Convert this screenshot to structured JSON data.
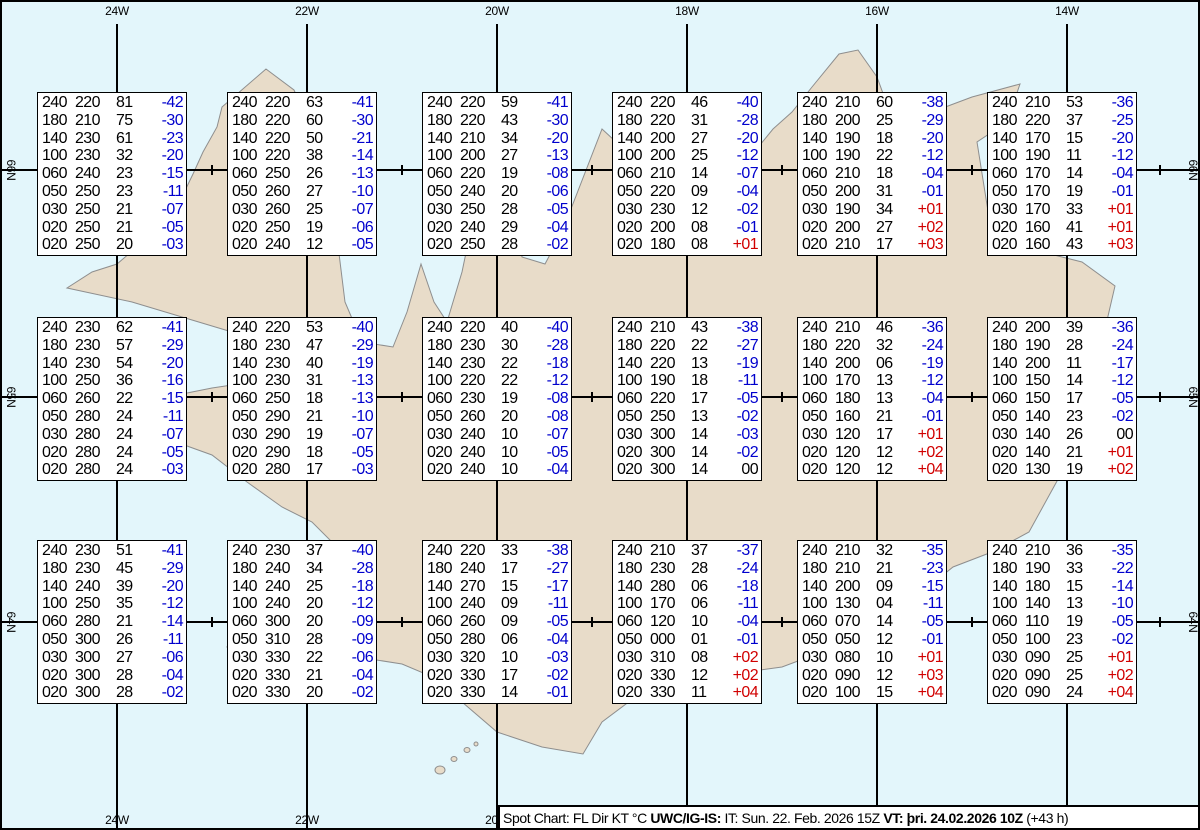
{
  "colors": {
    "ocean": "#e3f6fb",
    "land": "#e8dcc9",
    "coast": "#8e8e8e",
    "grid": "#000000",
    "temp_negative": "#0000cd",
    "temp_positive": "#d10000",
    "temp_zero": "#000000"
  },
  "map": {
    "meridians": [
      "24W",
      "22W",
      "20W",
      "18W",
      "16W",
      "14W"
    ],
    "bottom_meridians": [
      "24W",
      "22W",
      "20W"
    ],
    "parallels": [
      "66N",
      "65N",
      "64N"
    ]
  },
  "spots": [
    {
      "lon": "24W",
      "lat": "66N",
      "levels": [
        [
          "240",
          "220",
          "81",
          "-42"
        ],
        [
          "180",
          "210",
          "75",
          "-30"
        ],
        [
          "140",
          "230",
          "61",
          "-23"
        ],
        [
          "100",
          "230",
          "32",
          "-20"
        ],
        [
          "060",
          "240",
          "23",
          "-15"
        ],
        [
          "050",
          "250",
          "23",
          "-11"
        ],
        [
          "030",
          "250",
          "21",
          "-07"
        ],
        [
          "020",
          "250",
          "21",
          "-05"
        ],
        [
          "020",
          "250",
          "20",
          "-03"
        ]
      ]
    },
    {
      "lon": "22W",
      "lat": "66N",
      "levels": [
        [
          "240",
          "220",
          "63",
          "-41"
        ],
        [
          "180",
          "220",
          "60",
          "-30"
        ],
        [
          "140",
          "220",
          "50",
          "-21"
        ],
        [
          "100",
          "220",
          "38",
          "-14"
        ],
        [
          "060",
          "250",
          "26",
          "-13"
        ],
        [
          "050",
          "260",
          "27",
          "-10"
        ],
        [
          "030",
          "260",
          "25",
          "-07"
        ],
        [
          "020",
          "250",
          "19",
          "-06"
        ],
        [
          "020",
          "240",
          "12",
          "-05"
        ]
      ]
    },
    {
      "lon": "20W",
      "lat": "66N",
      "levels": [
        [
          "240",
          "220",
          "59",
          "-41"
        ],
        [
          "180",
          "220",
          "43",
          "-30"
        ],
        [
          "140",
          "210",
          "34",
          "-20"
        ],
        [
          "100",
          "200",
          "27",
          "-13"
        ],
        [
          "060",
          "220",
          "19",
          "-08"
        ],
        [
          "050",
          "240",
          "20",
          "-06"
        ],
        [
          "030",
          "250",
          "28",
          "-05"
        ],
        [
          "020",
          "240",
          "29",
          "-04"
        ],
        [
          "020",
          "250",
          "28",
          "-02"
        ]
      ]
    },
    {
      "lon": "18W",
      "lat": "66N",
      "levels": [
        [
          "240",
          "220",
          "46",
          "-40"
        ],
        [
          "180",
          "220",
          "31",
          "-28"
        ],
        [
          "140",
          "200",
          "27",
          "-20"
        ],
        [
          "100",
          "200",
          "25",
          "-12"
        ],
        [
          "060",
          "210",
          "14",
          "-07"
        ],
        [
          "050",
          "220",
          "09",
          "-04"
        ],
        [
          "030",
          "230",
          "12",
          "-02"
        ],
        [
          "020",
          "200",
          "08",
          "-01"
        ],
        [
          "020",
          "180",
          "08",
          "+01"
        ]
      ]
    },
    {
      "lon": "16W",
      "lat": "66N",
      "levels": [
        [
          "240",
          "210",
          "60",
          "-38"
        ],
        [
          "180",
          "200",
          "25",
          "-29"
        ],
        [
          "140",
          "190",
          "18",
          "-20"
        ],
        [
          "100",
          "190",
          "22",
          "-12"
        ],
        [
          "060",
          "210",
          "18",
          "-04"
        ],
        [
          "050",
          "200",
          "31",
          "-01"
        ],
        [
          "030",
          "190",
          "34",
          "+01"
        ],
        [
          "020",
          "200",
          "27",
          "+02"
        ],
        [
          "020",
          "210",
          "17",
          "+03"
        ]
      ]
    },
    {
      "lon": "14W",
      "lat": "66N",
      "levels": [
        [
          "240",
          "210",
          "53",
          "-36"
        ],
        [
          "180",
          "220",
          "37",
          "-25"
        ],
        [
          "140",
          "170",
          "15",
          "-20"
        ],
        [
          "100",
          "190",
          "11",
          "-12"
        ],
        [
          "060",
          "170",
          "14",
          "-04"
        ],
        [
          "050",
          "170",
          "19",
          "-01"
        ],
        [
          "030",
          "170",
          "33",
          "+01"
        ],
        [
          "020",
          "160",
          "41",
          "+01"
        ],
        [
          "020",
          "160",
          "43",
          "+03"
        ]
      ]
    },
    {
      "lon": "24W",
      "lat": "65N",
      "levels": [
        [
          "240",
          "230",
          "62",
          "-41"
        ],
        [
          "180",
          "230",
          "57",
          "-29"
        ],
        [
          "140",
          "230",
          "54",
          "-20"
        ],
        [
          "100",
          "250",
          "36",
          "-16"
        ],
        [
          "060",
          "260",
          "22",
          "-15"
        ],
        [
          "050",
          "280",
          "24",
          "-11"
        ],
        [
          "030",
          "280",
          "24",
          "-07"
        ],
        [
          "020",
          "280",
          "24",
          "-05"
        ],
        [
          "020",
          "280",
          "24",
          "-03"
        ]
      ]
    },
    {
      "lon": "22W",
      "lat": "65N",
      "levels": [
        [
          "240",
          "220",
          "53",
          "-40"
        ],
        [
          "180",
          "230",
          "47",
          "-29"
        ],
        [
          "140",
          "230",
          "40",
          "-19"
        ],
        [
          "100",
          "230",
          "31",
          "-13"
        ],
        [
          "060",
          "250",
          "18",
          "-13"
        ],
        [
          "050",
          "290",
          "21",
          "-10"
        ],
        [
          "030",
          "290",
          "19",
          "-07"
        ],
        [
          "020",
          "290",
          "18",
          "-05"
        ],
        [
          "020",
          "280",
          "17",
          "-03"
        ]
      ]
    },
    {
      "lon": "20W",
      "lat": "65N",
      "levels": [
        [
          "240",
          "220",
          "40",
          "-40"
        ],
        [
          "180",
          "230",
          "30",
          "-28"
        ],
        [
          "140",
          "230",
          "22",
          "-18"
        ],
        [
          "100",
          "220",
          "22",
          "-12"
        ],
        [
          "060",
          "230",
          "19",
          "-08"
        ],
        [
          "050",
          "260",
          "20",
          "-08"
        ],
        [
          "030",
          "240",
          "10",
          "-07"
        ],
        [
          "020",
          "240",
          "10",
          "-05"
        ],
        [
          "020",
          "240",
          "10",
          "-04"
        ]
      ]
    },
    {
      "lon": "18W",
      "lat": "65N",
      "levels": [
        [
          "240",
          "210",
          "43",
          "-38"
        ],
        [
          "180",
          "220",
          "22",
          "-27"
        ],
        [
          "140",
          "220",
          "13",
          "-19"
        ],
        [
          "100",
          "190",
          "18",
          "-11"
        ],
        [
          "060",
          "220",
          "17",
          "-05"
        ],
        [
          "050",
          "250",
          "13",
          "-02"
        ],
        [
          "030",
          "300",
          "14",
          "-03"
        ],
        [
          "020",
          "300",
          "14",
          "-02"
        ],
        [
          "020",
          "300",
          "14",
          "00"
        ]
      ]
    },
    {
      "lon": "16W",
      "lat": "65N",
      "levels": [
        [
          "240",
          "210",
          "46",
          "-36"
        ],
        [
          "180",
          "220",
          "32",
          "-24"
        ],
        [
          "140",
          "200",
          "06",
          "-19"
        ],
        [
          "100",
          "170",
          "13",
          "-12"
        ],
        [
          "060",
          "180",
          "13",
          "-04"
        ],
        [
          "050",
          "160",
          "21",
          "-01"
        ],
        [
          "030",
          "120",
          "17",
          "+01"
        ],
        [
          "020",
          "120",
          "12",
          "+02"
        ],
        [
          "020",
          "120",
          "12",
          "+04"
        ]
      ]
    },
    {
      "lon": "14W",
      "lat": "65N",
      "levels": [
        [
          "240",
          "200",
          "39",
          "-36"
        ],
        [
          "180",
          "190",
          "28",
          "-24"
        ],
        [
          "140",
          "200",
          "11",
          "-17"
        ],
        [
          "100",
          "150",
          "14",
          "-12"
        ],
        [
          "060",
          "150",
          "17",
          "-05"
        ],
        [
          "050",
          "140",
          "23",
          "-02"
        ],
        [
          "030",
          "140",
          "26",
          "00"
        ],
        [
          "020",
          "140",
          "21",
          "+01"
        ],
        [
          "020",
          "130",
          "19",
          "+02"
        ]
      ]
    },
    {
      "lon": "24W",
      "lat": "64N",
      "levels": [
        [
          "240",
          "230",
          "51",
          "-41"
        ],
        [
          "180",
          "230",
          "45",
          "-29"
        ],
        [
          "140",
          "240",
          "39",
          "-20"
        ],
        [
          "100",
          "250",
          "35",
          "-12"
        ],
        [
          "060",
          "280",
          "21",
          "-14"
        ],
        [
          "050",
          "300",
          "26",
          "-11"
        ],
        [
          "030",
          "300",
          "27",
          "-06"
        ],
        [
          "020",
          "300",
          "28",
          "-04"
        ],
        [
          "020",
          "300",
          "28",
          "-02"
        ]
      ]
    },
    {
      "lon": "22W",
      "lat": "64N",
      "levels": [
        [
          "240",
          "230",
          "37",
          "-40"
        ],
        [
          "180",
          "240",
          "34",
          "-28"
        ],
        [
          "140",
          "240",
          "25",
          "-18"
        ],
        [
          "100",
          "240",
          "20",
          "-12"
        ],
        [
          "060",
          "300",
          "20",
          "-09"
        ],
        [
          "050",
          "310",
          "28",
          "-09"
        ],
        [
          "030",
          "330",
          "22",
          "-06"
        ],
        [
          "020",
          "330",
          "21",
          "-04"
        ],
        [
          "020",
          "330",
          "20",
          "-02"
        ]
      ]
    },
    {
      "lon": "20W",
      "lat": "64N",
      "levels": [
        [
          "240",
          "220",
          "33",
          "-38"
        ],
        [
          "180",
          "240",
          "17",
          "-27"
        ],
        [
          "140",
          "270",
          "15",
          "-17"
        ],
        [
          "100",
          "240",
          "09",
          "-11"
        ],
        [
          "060",
          "260",
          "09",
          "-05"
        ],
        [
          "050",
          "280",
          "06",
          "-04"
        ],
        [
          "030",
          "320",
          "10",
          "-03"
        ],
        [
          "020",
          "330",
          "17",
          "-02"
        ],
        [
          "020",
          "330",
          "14",
          "-01"
        ]
      ]
    },
    {
      "lon": "18W",
      "lat": "64N",
      "levels": [
        [
          "240",
          "210",
          "37",
          "-37"
        ],
        [
          "180",
          "230",
          "28",
          "-24"
        ],
        [
          "140",
          "280",
          "06",
          "-18"
        ],
        [
          "100",
          "170",
          "06",
          "-11"
        ],
        [
          "060",
          "120",
          "10",
          "-04"
        ],
        [
          "050",
          "000",
          "01",
          "-01"
        ],
        [
          "030",
          "310",
          "08",
          "+02"
        ],
        [
          "020",
          "330",
          "12",
          "+02"
        ],
        [
          "020",
          "330",
          "11",
          "+04"
        ]
      ]
    },
    {
      "lon": "16W",
      "lat": "64N",
      "levels": [
        [
          "240",
          "210",
          "32",
          "-35"
        ],
        [
          "180",
          "210",
          "21",
          "-23"
        ],
        [
          "140",
          "200",
          "09",
          "-15"
        ],
        [
          "100",
          "130",
          "04",
          "-11"
        ],
        [
          "060",
          "070",
          "14",
          "-05"
        ],
        [
          "050",
          "050",
          "12",
          "-01"
        ],
        [
          "030",
          "080",
          "10",
          "+01"
        ],
        [
          "020",
          "090",
          "12",
          "+03"
        ],
        [
          "020",
          "100",
          "15",
          "+04"
        ]
      ]
    },
    {
      "lon": "14W",
      "lat": "64N",
      "levels": [
        [
          "240",
          "210",
          "36",
          "-35"
        ],
        [
          "180",
          "190",
          "33",
          "-22"
        ],
        [
          "140",
          "180",
          "15",
          "-14"
        ],
        [
          "100",
          "140",
          "13",
          "-10"
        ],
        [
          "060",
          "110",
          "19",
          "-05"
        ],
        [
          "050",
          "100",
          "23",
          "-02"
        ],
        [
          "030",
          "090",
          "25",
          "+01"
        ],
        [
          "020",
          "090",
          "25",
          "+02"
        ],
        [
          "020",
          "090",
          "24",
          "+04"
        ]
      ]
    }
  ],
  "status": {
    "legend": "Spot Chart: FL Dir KT °C ",
    "source": "UWC/IG-IS:",
    "issue_time": " IT: Sun. 22. Feb. 2026 15Z ",
    "valid_time": "VT: þri. 24.02.2026 10Z",
    "offset": " (+43 h)"
  }
}
